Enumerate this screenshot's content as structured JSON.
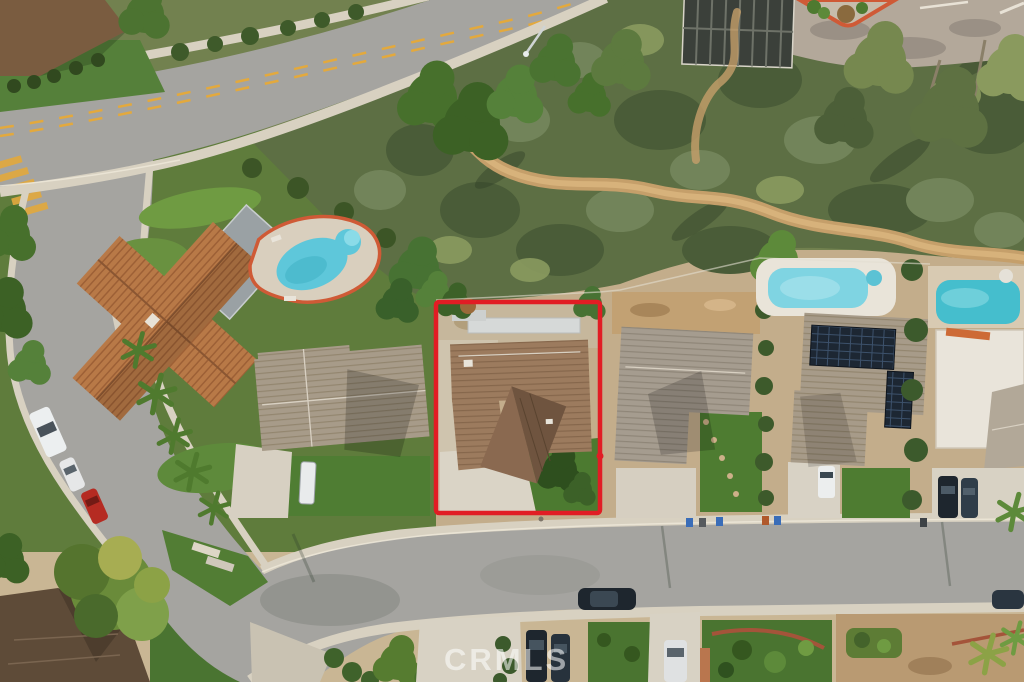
{
  "photo": {
    "kind_label": "aerial-neighborhood-photo",
    "watermark_text": "CRMLS"
  },
  "colors": {
    "boundary_red": "#e11d24",
    "asphalt": "#a5a4a0",
    "concrete": "#d8d1c1",
    "lane_yellow": "#e3a93d",
    "curb_red": "#cf5a36",
    "grass": "#4e7c31",
    "scrub_green": "#5d6f44",
    "trail_dirt": "#c59f6a",
    "trail_core": "#d9b57e",
    "tile_roof_orange": "#b87947",
    "subject_roof_brown": "#9c7b5e",
    "pool_water_1": "#5ec7da",
    "pool_water_2": "#7fd4e2",
    "pool_water_3": "#45becd",
    "solar_panel": "#1d2733",
    "red_car": "#b52b22",
    "dark_car": "#1e262e"
  },
  "scene_objects": {
    "subject_property": "red-outlined lot with brown hip-roof house, driveway and lawn",
    "pools_visible": 3,
    "watermark": "CRMLS"
  }
}
